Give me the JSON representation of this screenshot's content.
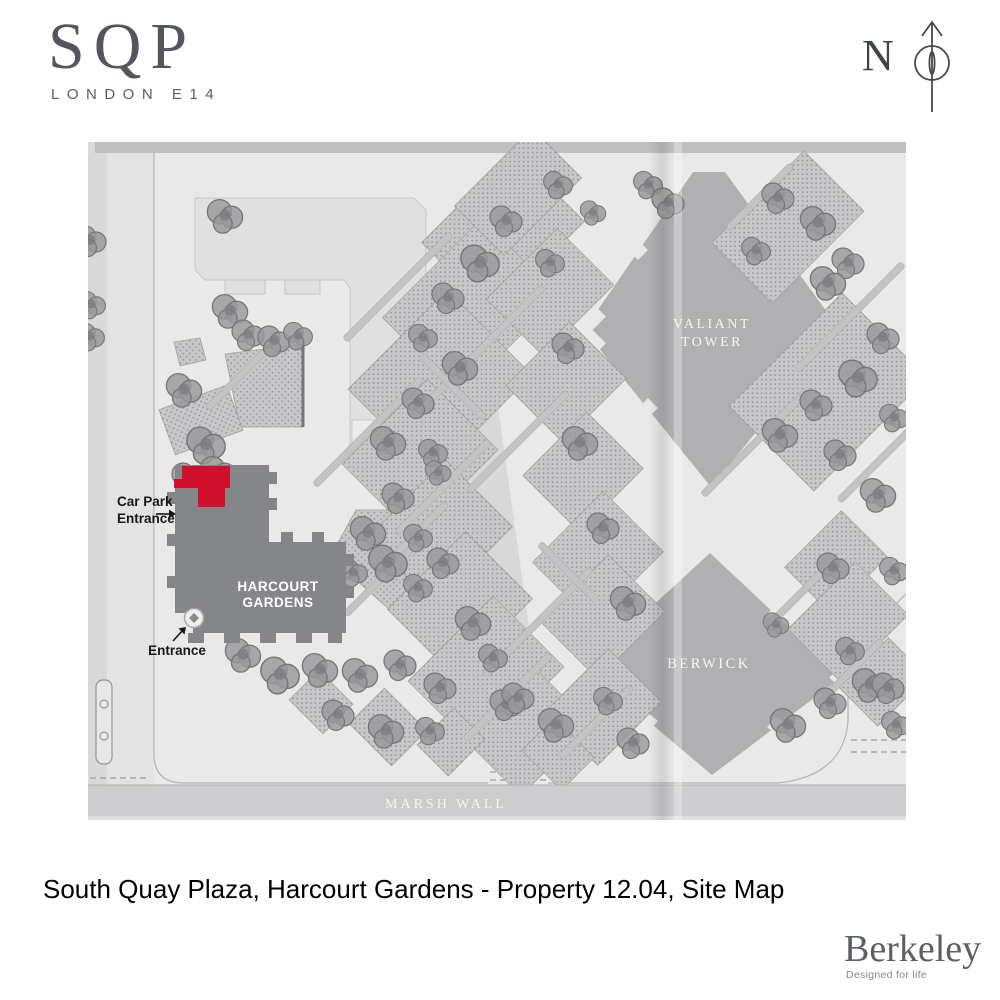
{
  "header": {
    "logo_text": "SQP",
    "logo_subtext": "LONDON E14",
    "compass_label": "N"
  },
  "map": {
    "highlight_color": "#D11030",
    "labels": {
      "valiant_line1": "VALIANT",
      "valiant_line2": "TOWER",
      "berwick": "BERWICK",
      "harcourt_line1": "HARCOURT",
      "harcourt_line2": "GARDENS",
      "marsh_wall": "MARSH WALL",
      "car_park_line1": "Car Park",
      "car_park_line2": "Entrance",
      "entrance": "Entrance"
    }
  },
  "caption": "South Quay Plaza, Harcourt Gardens - Property 12.04, Site Map",
  "footer": {
    "brand": "Berkeley",
    "tagline": "Designed for life"
  }
}
